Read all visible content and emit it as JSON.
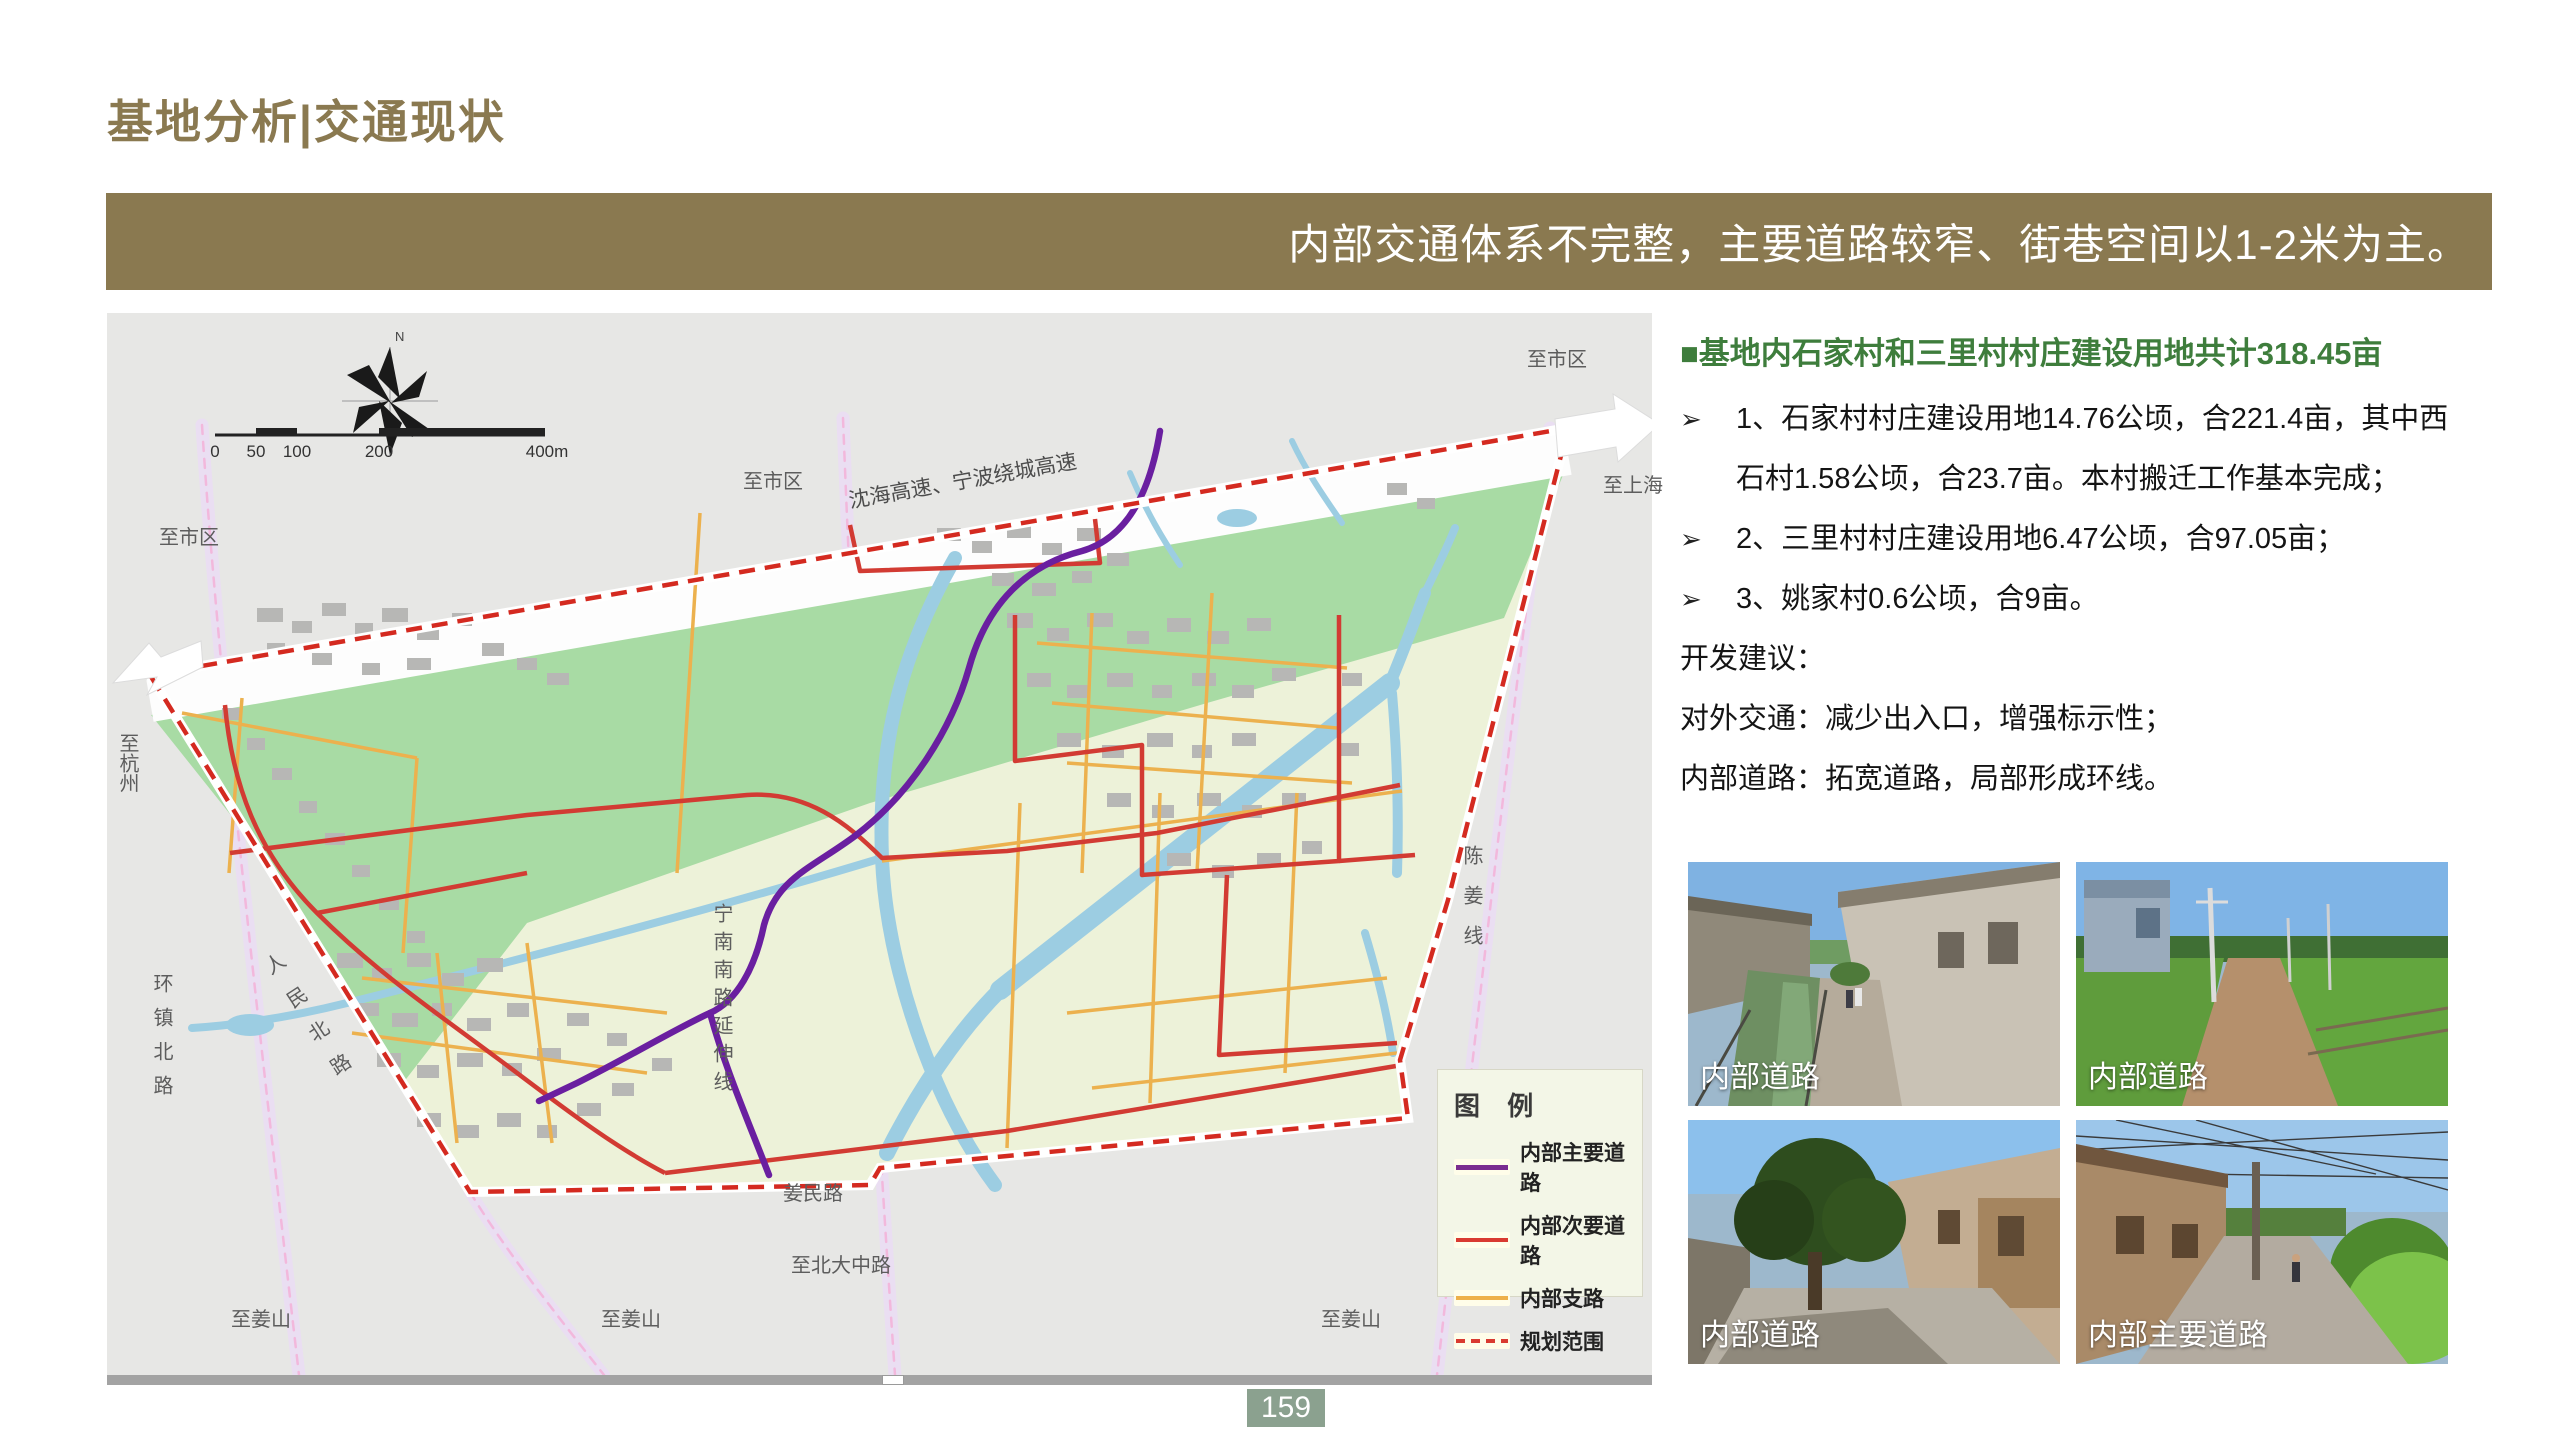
{
  "slide": {
    "title": "基地分析|交通现状",
    "banner_text": "内部交通体系不完整，主要道路较窄、街巷空间以1-2米为主。",
    "page_number": "159"
  },
  "right_panel": {
    "heading": "■基地内石家村和三里村村庄建设用地共计318.45亩",
    "bullet_marker": "➢",
    "bullets": [
      "1、石家村村庄建设用地14.76公顷，合221.4亩，其中西石村1.58公顷，合23.7亩。本村搬迁工作基本完成；",
      "2、三里村村庄建设用地6.47公顷，合97.05亩；",
      "3、姚家村0.6公顷，合9亩。"
    ],
    "notes": [
      "开发建议：",
      "对外交通：减少出入口，增强标示性；",
      "内部道路：拓宽道路，局部形成环线。"
    ]
  },
  "map": {
    "compass_label": "N",
    "scale_labels": [
      "0",
      "50",
      "100",
      "200",
      "400m"
    ],
    "labels": [
      {
        "text": "至市区"
      },
      {
        "text": "至市区"
      },
      {
        "text": "至市区"
      },
      {
        "text": "沈海高速、宁波绕城高速"
      },
      {
        "text": "至上海"
      },
      {
        "text": "至杭州"
      },
      {
        "text": "环镇北路"
      },
      {
        "text": "人民北路"
      },
      {
        "text": "宁南南路延伸线"
      },
      {
        "text": "姜民路"
      },
      {
        "text": "至北大中路"
      },
      {
        "text": "至姜山"
      },
      {
        "text": "至姜山"
      },
      {
        "text": "至姜山"
      },
      {
        "text": "陈姜线"
      }
    ],
    "legend": {
      "title": "图 例",
      "items": [
        {
          "label": "内部主要道路",
          "color": "#7b2d90",
          "style": "solid"
        },
        {
          "label": "内部次要道路",
          "color": "#d93a30",
          "style": "solid"
        },
        {
          "label": "内部支路",
          "color": "#eeb04a",
          "style": "solid"
        },
        {
          "label": "规划范围",
          "color": "#d93a30",
          "style": "dashed"
        }
      ]
    }
  },
  "photos": [
    {
      "caption": "内部道路"
    },
    {
      "caption": "内部道路"
    },
    {
      "caption": "内部道路"
    },
    {
      "caption": "内部主要道路"
    }
  ],
  "colors": {
    "accent_olive": "#8a7950",
    "heading_green": "#3e7d3c",
    "badge_green": "#8ba18f",
    "boundary_red": "#d42a20",
    "road_purple": "#6a1fa0",
    "road_red": "#d23b33",
    "road_orange": "#ecb14e",
    "river_blue": "#9ccde2",
    "farmland_green": "#a8dba4",
    "site_cream": "#edf2d9"
  }
}
